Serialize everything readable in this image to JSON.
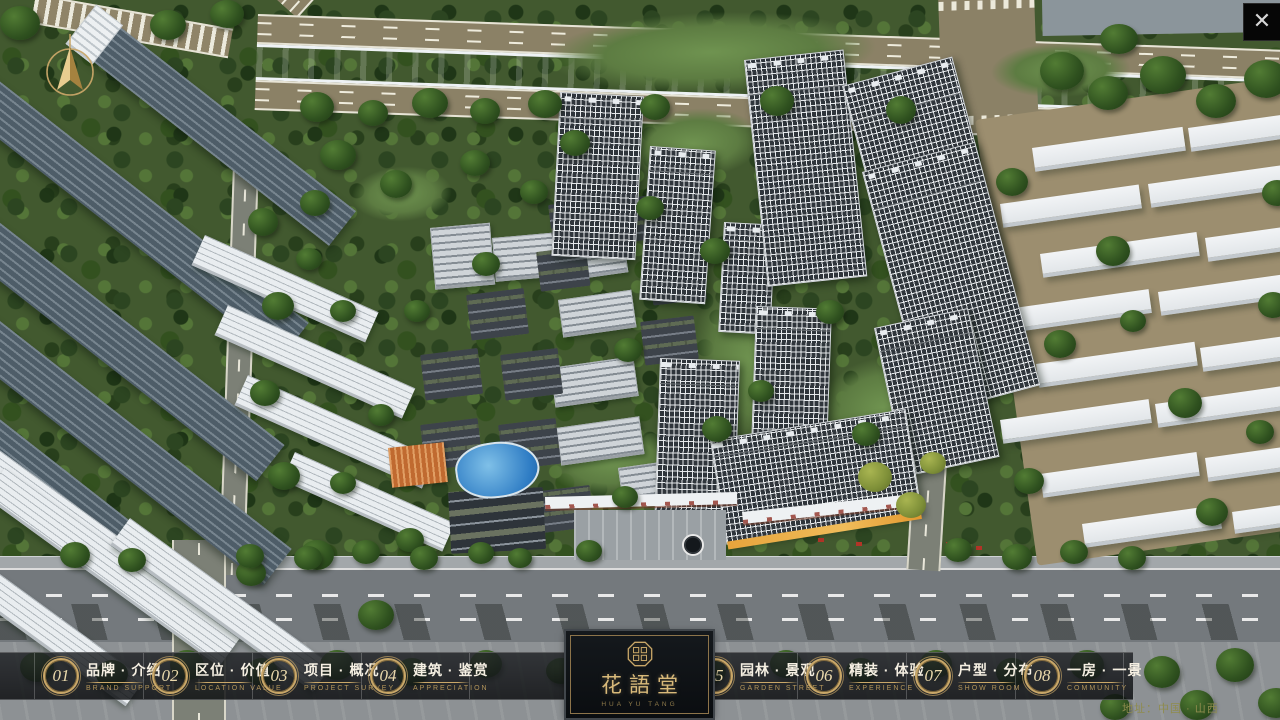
{
  "window": {
    "close_icon": "✕"
  },
  "nav": {
    "items": [
      {
        "num": "01",
        "title": "品牌 · 介绍",
        "subtitle": "BRAND SUPPORT"
      },
      {
        "num": "02",
        "title": "区位 · 价值",
        "subtitle": "LOCATION VALUE"
      },
      {
        "num": "03",
        "title": "项目 · 概况",
        "subtitle": "PROJECT SURVEY"
      },
      {
        "num": "04",
        "title": "建筑 · 鉴赏",
        "subtitle": "APPRECIATION"
      },
      {
        "num": "05",
        "title": "园林 · 景观",
        "subtitle": "GARDEN STREET"
      },
      {
        "num": "06",
        "title": "精装 · 体验",
        "subtitle": "EXPERIENCE"
      },
      {
        "num": "07",
        "title": "户型 · 分布",
        "subtitle": "SHOW ROOM"
      },
      {
        "num": "08",
        "title": "一房 · 一景",
        "subtitle": "COMMUNITY"
      }
    ]
  },
  "logo": {
    "title": "花語堂",
    "subtitle": "HUA YU TANG"
  },
  "footer": {
    "address": "地址：中国 · 山西"
  },
  "colors": {
    "gold": "#c9a768",
    "river": "#2c63bd",
    "bar_bg": "rgba(16,18,21,0.84)"
  }
}
